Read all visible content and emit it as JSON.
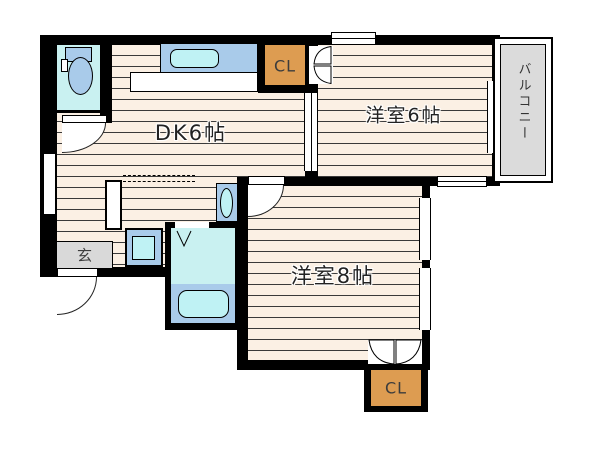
{
  "plan_type": "apartment-floor-plan",
  "rooms": {
    "dk": {
      "label": "DK6帖"
    },
    "west6": {
      "label": "洋室6帖"
    },
    "west8": {
      "label": "洋室8帖"
    }
  },
  "closets": {
    "top": {
      "label": "CL"
    },
    "bottom": {
      "label": "CL"
    }
  },
  "entrance": {
    "label": "玄"
  },
  "balcony": {
    "label": "バルコニー"
  },
  "fixtures": [
    "toilet-icon",
    "kitchen-sink-icon",
    "washbasin-icon",
    "washing-machine-icon",
    "shower-room",
    "bathtub-icon"
  ],
  "colors": {
    "floor_stripe_base": "#fbf0e4",
    "wall": "#000000",
    "closet_orange": "#dd9c51",
    "water_cyan": "#c9f1f1",
    "fixture_blue": "#a9cbea",
    "sink_cyan": "#bff2f4",
    "entrance_gray": "#d9d9d9",
    "balcony_gray": "#dbdbdb"
  }
}
